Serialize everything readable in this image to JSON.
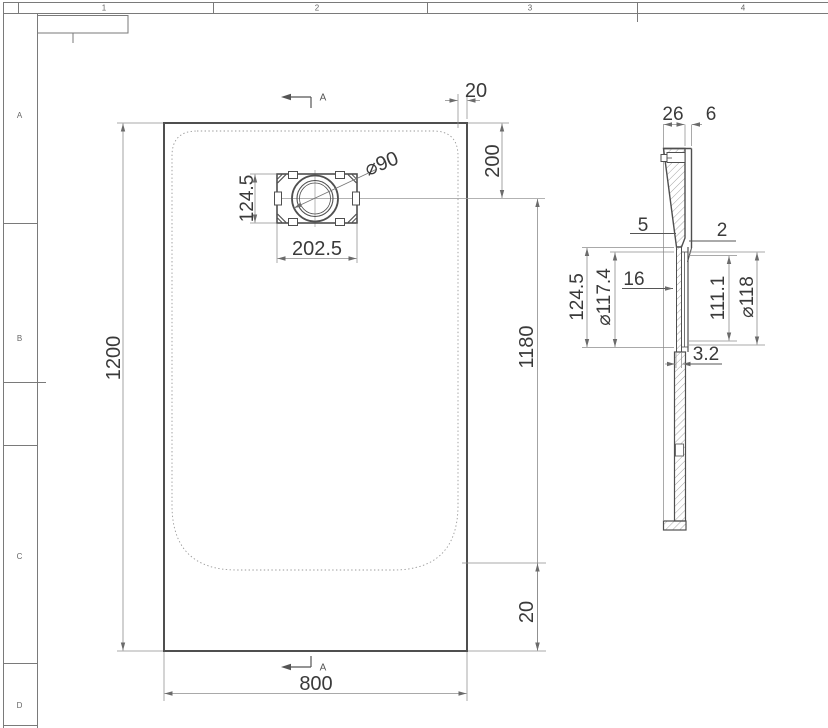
{
  "sheet": {
    "grid_columns": [
      "1",
      "2",
      "3",
      "4"
    ],
    "grid_rows": [
      "A",
      "B",
      "C",
      "D"
    ]
  },
  "plan_view": {
    "dim_height": "1200",
    "dim_width": "800",
    "dim_right": "1180",
    "dim_top_offset": "200",
    "dim_top_edge": "20",
    "dim_bottom_edge": "20",
    "drain": {
      "dim_width": "202.5",
      "dim_height": "124.5",
      "dim_diameter": "⌀90"
    },
    "section_mark_top": "A",
    "section_mark_bottom": "A"
  },
  "section_view": {
    "dim_top_width": "26",
    "dim_lip": "6",
    "dim_left_note": "5",
    "dim_right_note": "2",
    "dim_recess_outer": "124.5",
    "dim_recess_inner_dia": "⌀117.4",
    "dim_neck": "16",
    "dim_depth": "111.1",
    "dim_flange_dia": "⌀118",
    "dim_plate_thickness": "3.2"
  },
  "colors": {
    "background": "#ffffff",
    "outline": "#4f4f4f",
    "dimension": "#8c8c8c",
    "text": "#3a3a3a",
    "frame": "#7a7a7a"
  }
}
